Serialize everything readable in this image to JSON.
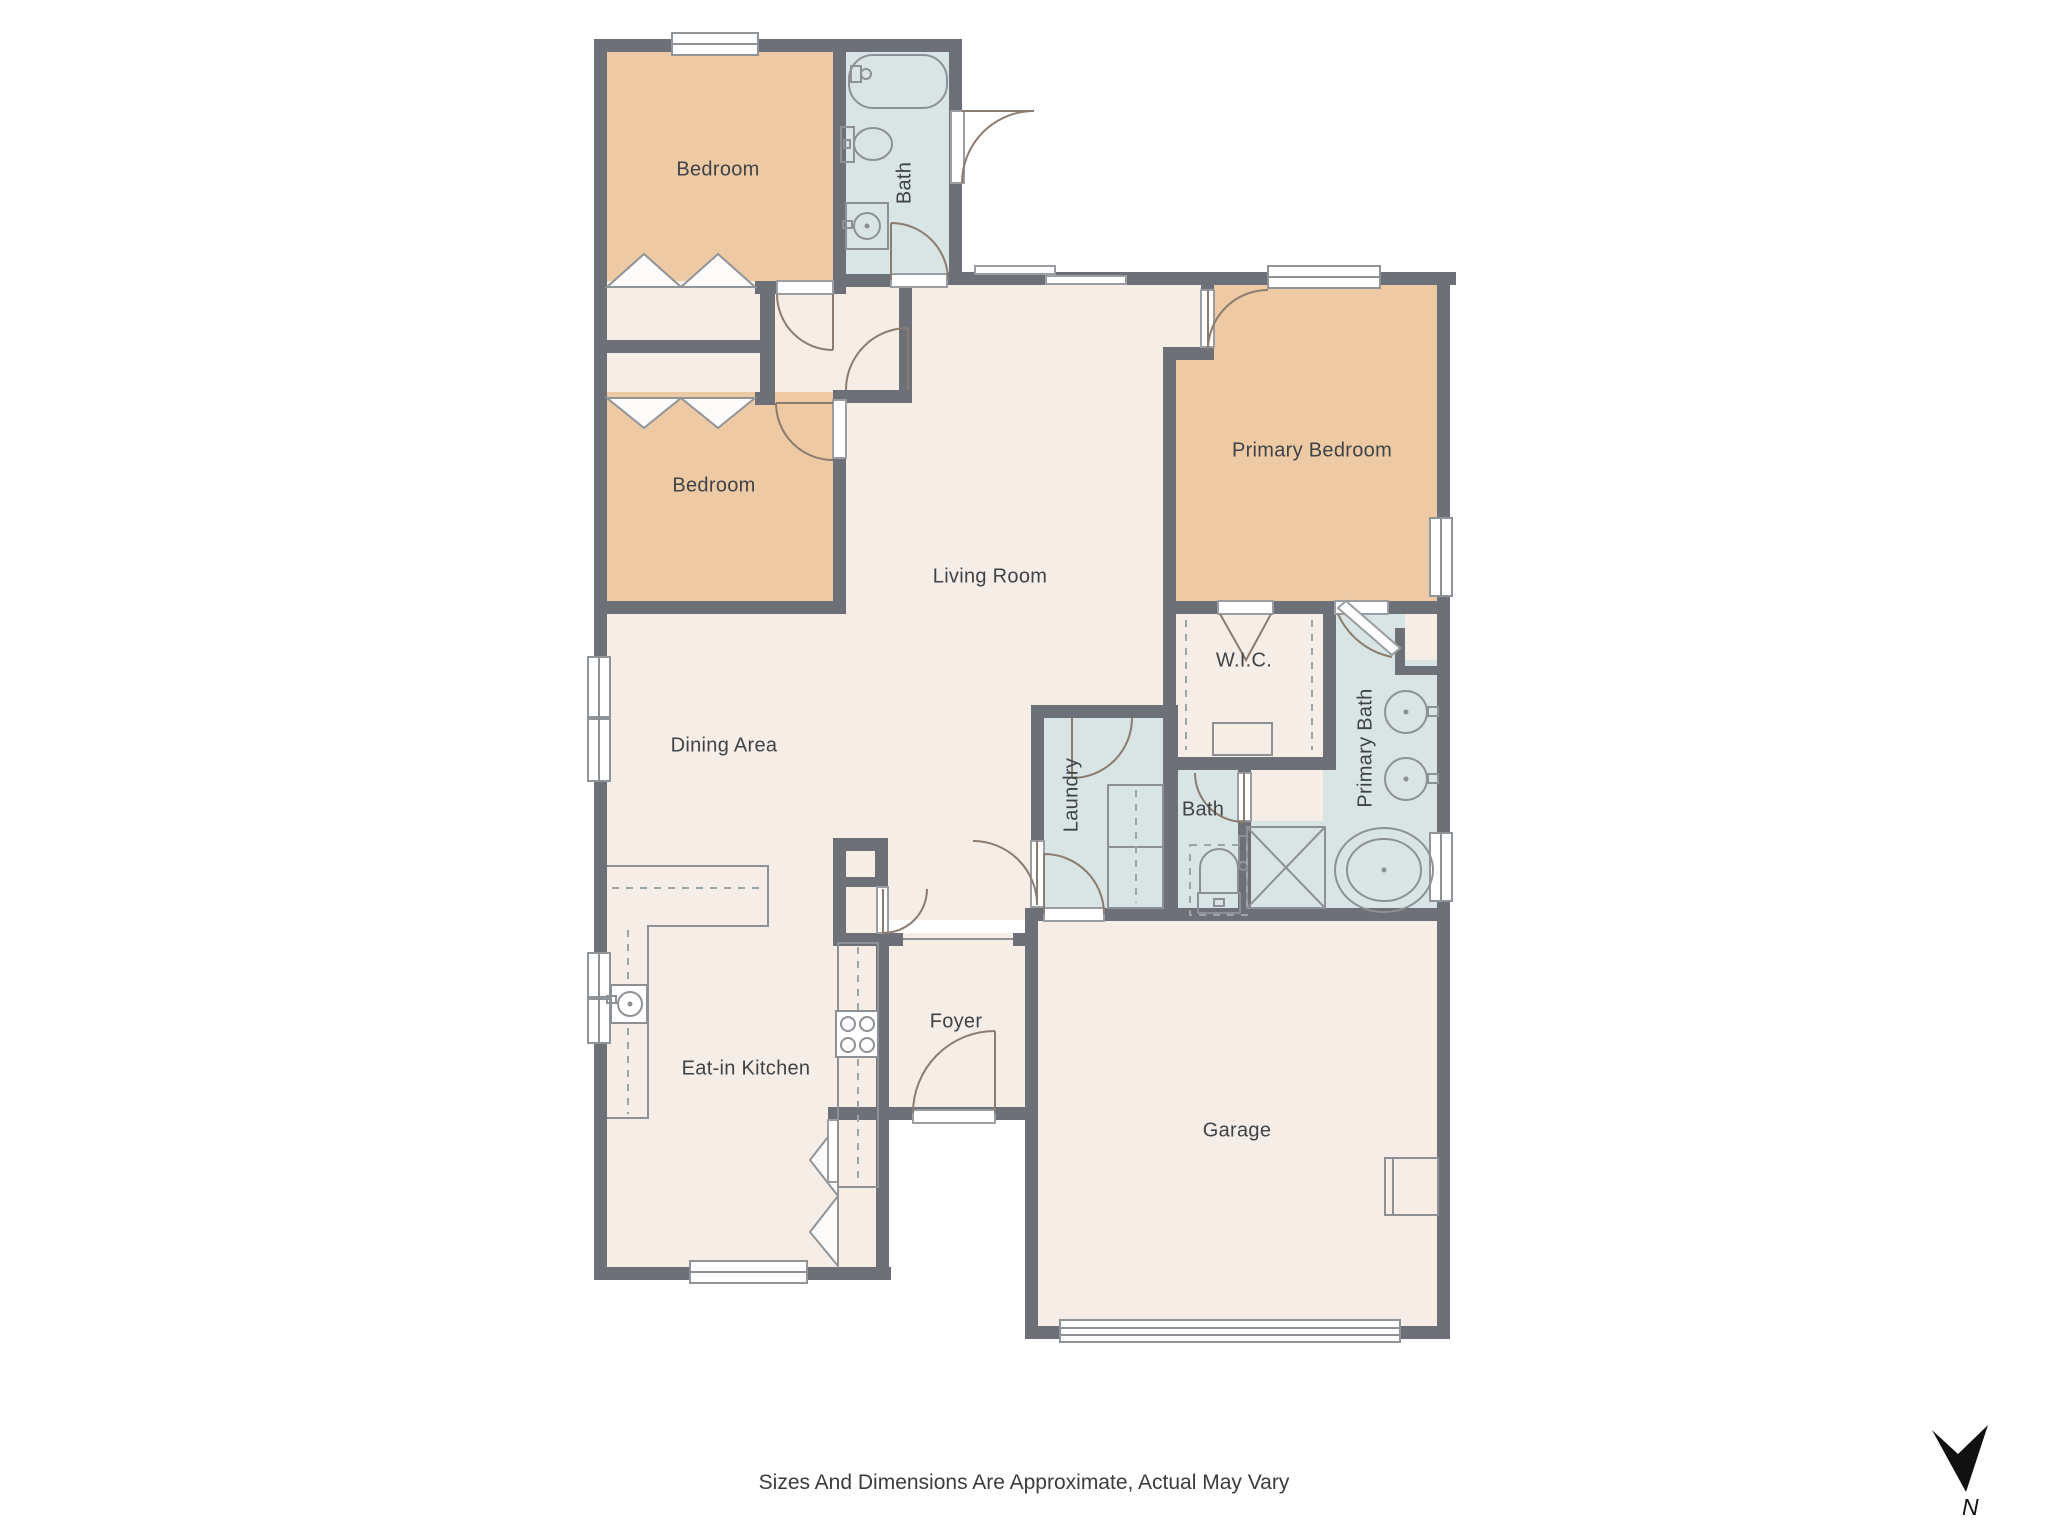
{
  "colors": {
    "wall": "#6d7177",
    "bedroom_fill": "#eecaa4",
    "bath_fill": "#d8e5e4",
    "floor_fill": "#f6ede7",
    "closet_fill": "#f5ede6",
    "arc": "#8c7b6f",
    "fixture": "#8d9196",
    "text": "#3f4347",
    "compass": "#111111"
  },
  "rooms": [
    {
      "id": "bedroom-1",
      "label": "Bedroom"
    },
    {
      "id": "bath-1",
      "label": "Bath"
    },
    {
      "id": "bedroom-2",
      "label": "Bedroom"
    },
    {
      "id": "primary-bedroom",
      "label": "Primary Bedroom"
    },
    {
      "id": "living-room",
      "label": "Living Room"
    },
    {
      "id": "wic",
      "label": "W.I.C."
    },
    {
      "id": "dining-area",
      "label": "Dining Area"
    },
    {
      "id": "primary-bath",
      "label": "Primary Bath"
    },
    {
      "id": "laundry",
      "label": "Laundry"
    },
    {
      "id": "bath-2",
      "label": "Bath"
    },
    {
      "id": "foyer",
      "label": "Foyer"
    },
    {
      "id": "eat-in-kitchen",
      "label": "Eat-in Kitchen"
    },
    {
      "id": "garage",
      "label": "Garage"
    }
  ],
  "footer": {
    "disclaimer": "Sizes And Dimensions Are Approximate, Actual May Vary"
  },
  "compass": {
    "label": "N"
  }
}
